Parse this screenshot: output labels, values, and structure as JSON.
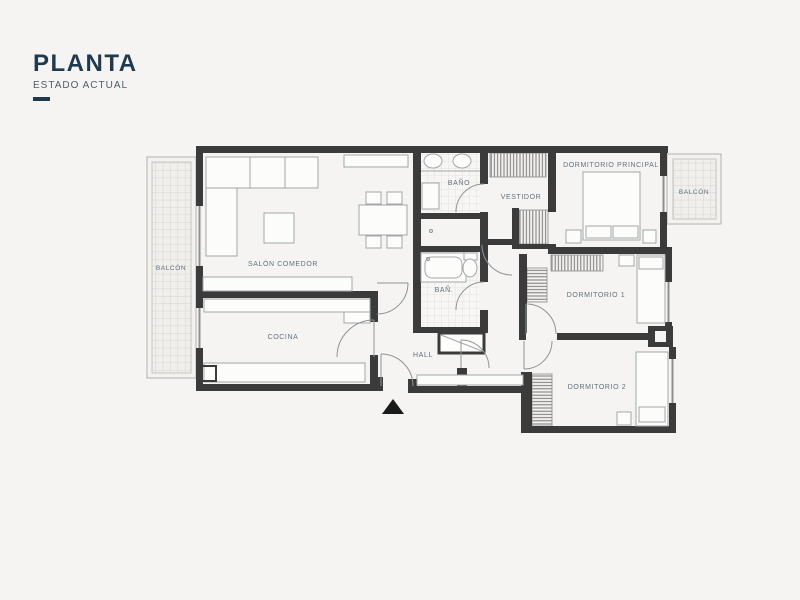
{
  "title": {
    "heading": "PLANTA",
    "subtitle": "ESTADO ACTUAL"
  },
  "rooms": {
    "salon": {
      "label": "SALÓN COMEDOR"
    },
    "cocina": {
      "label": "COCINA"
    },
    "hall": {
      "label": "HALL"
    },
    "bano_principal": {
      "label": "BAÑO"
    },
    "bano_2": {
      "label": "BAÑ."
    },
    "vestidor": {
      "label": "VESTIDOR"
    },
    "dormitorio_principal": {
      "label": "DORMITORIO PRINCIPAL"
    },
    "dormitorio_1": {
      "label": "DORMITORIO 1"
    },
    "dormitorio_2": {
      "label": "DORMITORIO 2"
    },
    "balcon_izquierdo": {
      "label": "BALCÓN"
    },
    "balcon_derecho": {
      "label": "BALCÓN"
    }
  },
  "markers": {
    "entrance": "triangle-up"
  },
  "colors": {
    "background": "#f5f4f2",
    "wall": "#3b3b3b",
    "title": "#1d3a50",
    "label": "#5f7280",
    "furniture_stroke": "#a3a7aa",
    "entrance_marker": "#1a1a1a"
  }
}
